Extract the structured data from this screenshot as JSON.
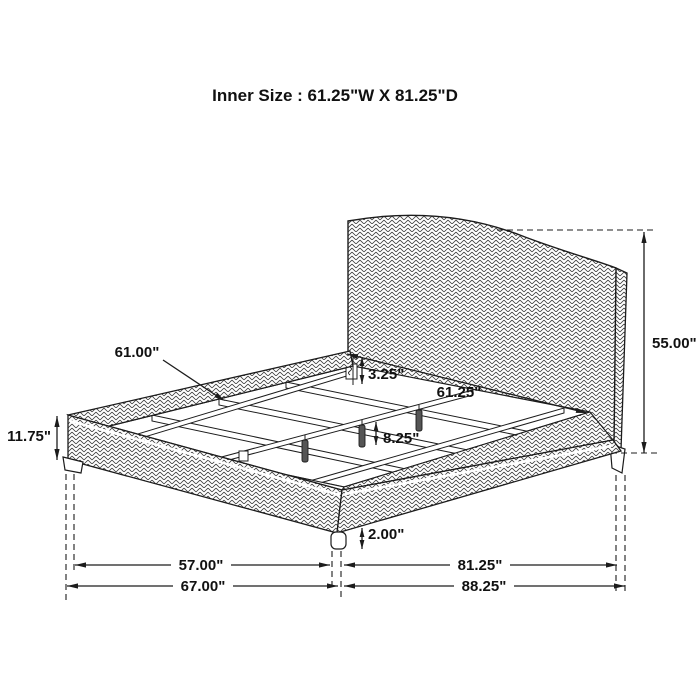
{
  "title": "Inner Size : 61.25\"W X 81.25\"D",
  "diagram": {
    "subject": "upholstered-platform-bed-dimension-drawing",
    "units": "inches"
  },
  "dimensions": {
    "slat_length": "61.00\"",
    "slat_drop": "3.25\"",
    "inner_width": "61.25\"",
    "headboard_height": "55.00\"",
    "side_rail_height": "11.75\"",
    "center_leg_length": "8.25\"",
    "foot_leg_height": "2.00\"",
    "width_between_legs": "57.00\"",
    "overall_width": "67.00\"",
    "depth_leg_to_headboard": "81.25\"",
    "overall_depth": "88.25\""
  },
  "colors": {
    "line": "#1c1c1c",
    "background": "#ffffff",
    "leg_fill": "#555555"
  }
}
